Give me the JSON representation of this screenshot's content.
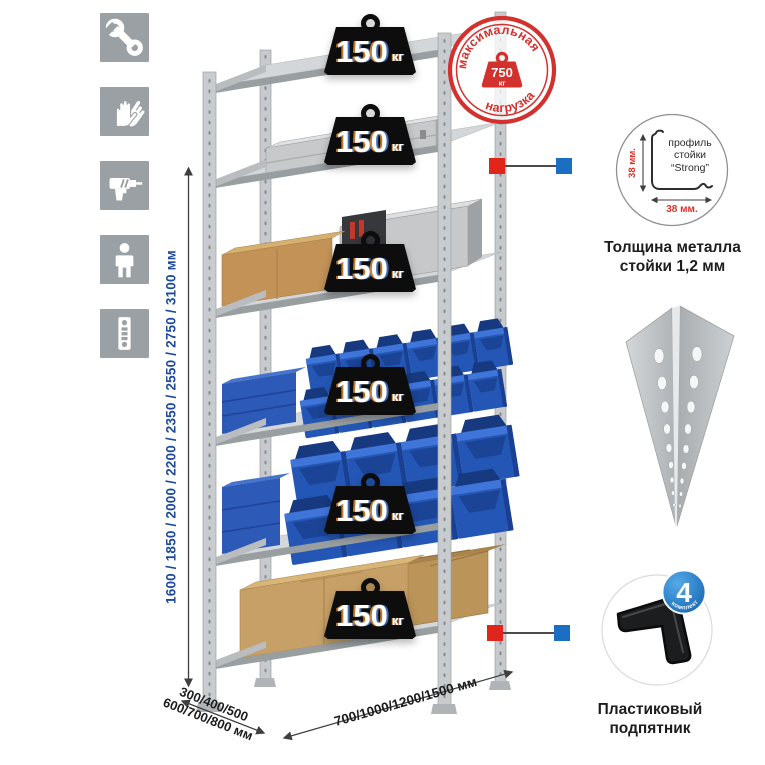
{
  "sidebar": {
    "icons": [
      {
        "name": "wrench"
      },
      {
        "name": "gloves"
      },
      {
        "name": "drill"
      },
      {
        "name": "person"
      },
      {
        "name": "perforated-post"
      }
    ]
  },
  "dimensions": {
    "height_label": "1600 / 1850 / 2000 / 2200 / 2350 / 2550 / 2750 / 3100 мм",
    "depth_line1": "300/400/500",
    "depth_line2": "600/700/800 мм",
    "width_label": "700/1000/1200/1500 мм"
  },
  "shelf_weight": {
    "value": "150",
    "unit": "кг"
  },
  "stamp": {
    "arc_top": "максимальная",
    "arc_bottom": "нагрузка",
    "value": "750",
    "unit": "кг"
  },
  "profile_detail": {
    "dim_v": "38 мм.",
    "dim_h": "38 мм.",
    "line1": "профиль",
    "line2": "стойки",
    "line3": "“Strong”",
    "caption_line1": "Толщина металла",
    "caption_line2": "стойки 1,2 мм"
  },
  "foot_detail": {
    "badge_value": "4",
    "badge_arc": "в комплекте",
    "caption_line1": "Пластиковый",
    "caption_line2": "подпятник"
  },
  "colors": {
    "accent_red": "#d8312d",
    "accent_blue": "#1b6ec2",
    "dim_text_blue": "#1b4a9e",
    "weight_black": "#0d0d0d",
    "bin_blue": "#2457b5",
    "icon_gray": "#9aa0a3"
  }
}
